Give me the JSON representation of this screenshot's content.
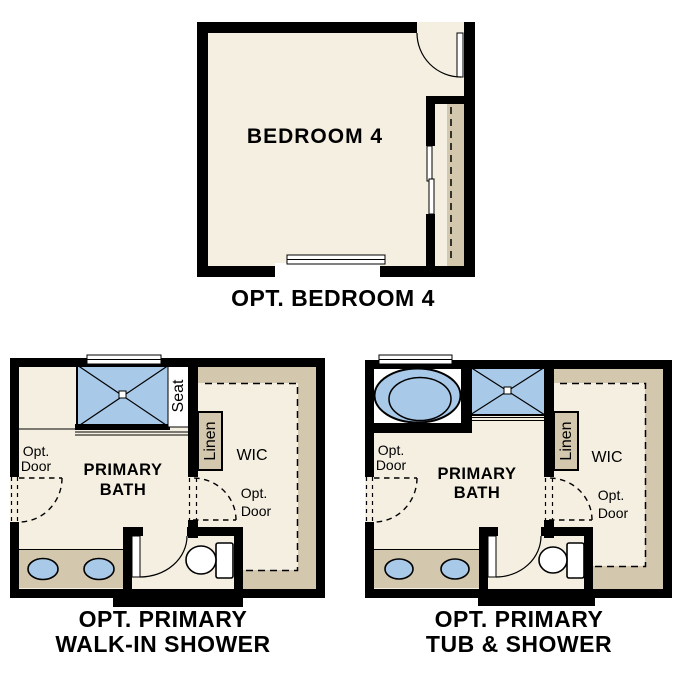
{
  "colors": {
    "floor": "#f5efe2",
    "tan": "#d3c7ae",
    "blue": "#a9c9e8",
    "wall": "#000000",
    "background": "#ffffff"
  },
  "plans": {
    "bedroom4": {
      "caption": "OPT. BEDROOM 4",
      "room_label": "BEDROOM 4"
    },
    "walk_in_shower": {
      "caption_line1": "OPT. PRIMARY",
      "caption_line2": "WALK-IN SHOWER",
      "bath_line1": "PRIMARY",
      "bath_line2": "BATH",
      "wic": "WIC",
      "linen": "Linen",
      "seat": "Seat",
      "opt_door_left_line1": "Opt.",
      "opt_door_left_line2": "Door",
      "opt_door_wic_line1": "Opt.",
      "opt_door_wic_line2": "Door"
    },
    "tub_shower": {
      "caption_line1": "OPT. PRIMARY",
      "caption_line2": "TUB & SHOWER",
      "bath_line1": "PRIMARY",
      "bath_line2": "BATH",
      "wic": "WIC",
      "linen": "Linen",
      "opt_door_left_line1": "Opt.",
      "opt_door_left_line2": "Door",
      "opt_door_wic_line1": "Opt.",
      "opt_door_wic_line2": "Door"
    }
  }
}
